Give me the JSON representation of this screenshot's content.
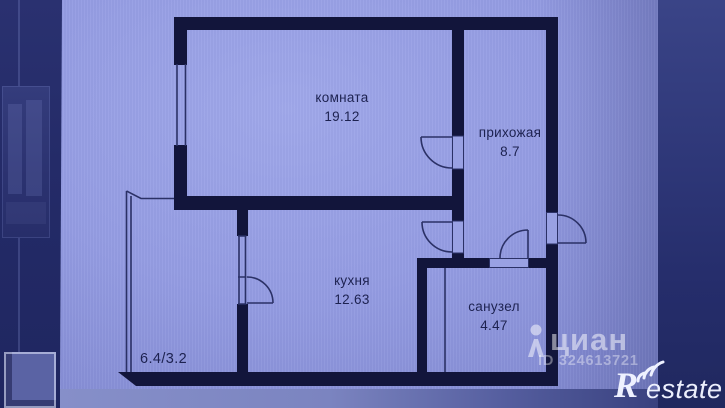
{
  "floorplan": {
    "rooms": [
      {
        "name": "комната",
        "area": "19.12"
      },
      {
        "name": "прихожая",
        "area": "8.7"
      },
      {
        "name": "кухня",
        "area": "12.63"
      },
      {
        "name": "санузел",
        "area": "4.47"
      }
    ],
    "balcony_area": "6.4/3.2"
  },
  "watermarks": {
    "cian_text": "циан",
    "listing_id": "ID 324613721",
    "restate_r": "R",
    "restate_suffix": "estate"
  },
  "colors": {
    "paper": "#949ce2",
    "walls": "#12153b",
    "thin_lines": "#2b3166",
    "label_text": "#1d2250",
    "photo_dark_edge": "#252d6b",
    "watermark": "#ffffff"
  }
}
